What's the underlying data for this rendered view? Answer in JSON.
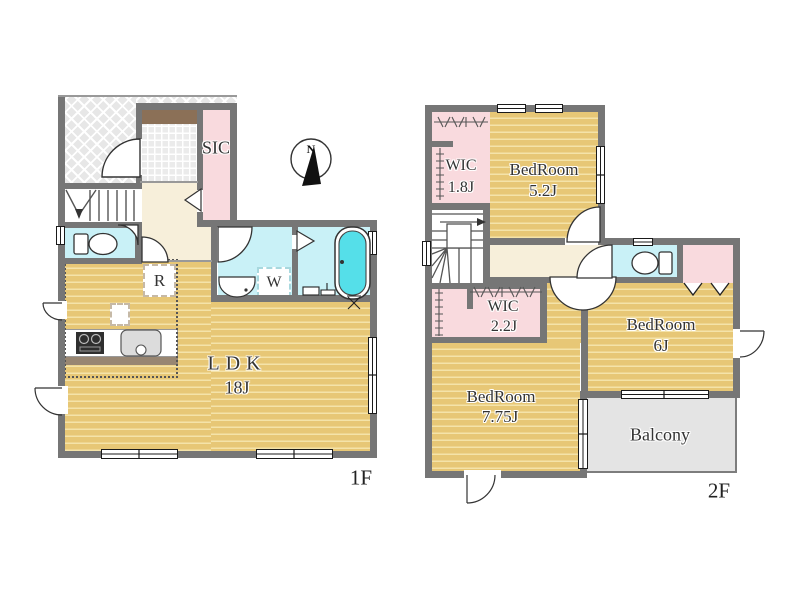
{
  "compass": {
    "north_label": "N"
  },
  "floor1": {
    "label": "1F",
    "rooms": {
      "sic": {
        "name": "SIC"
      },
      "ldk": {
        "name": "LDK",
        "size": "18J"
      },
      "refrigerator": {
        "name": "R"
      },
      "washer": {
        "name": "W"
      }
    }
  },
  "floor2": {
    "label": "2F",
    "rooms": {
      "wic_18": {
        "name": "WIC",
        "size": "1.8J"
      },
      "bedroom_52": {
        "name": "BedRoom",
        "size": "5.2J"
      },
      "wic_22": {
        "name": "WIC",
        "size": "2.2J"
      },
      "bedroom_6": {
        "name": "BedRoom",
        "size": "6J"
      },
      "bedroom_775": {
        "name": "BedRoom",
        "size": "7.75J"
      },
      "balcony": {
        "name": "Balcony"
      }
    }
  },
  "colors": {
    "wall": "#767676",
    "floor_wood": "#e7c776",
    "room_pink": "#f9dade",
    "wet_area_cyan": "#c9f1f7",
    "hall_cream": "#f7efda",
    "balcony_gray": "#e4e4e4",
    "tub_cyan": "#55dfe9"
  }
}
